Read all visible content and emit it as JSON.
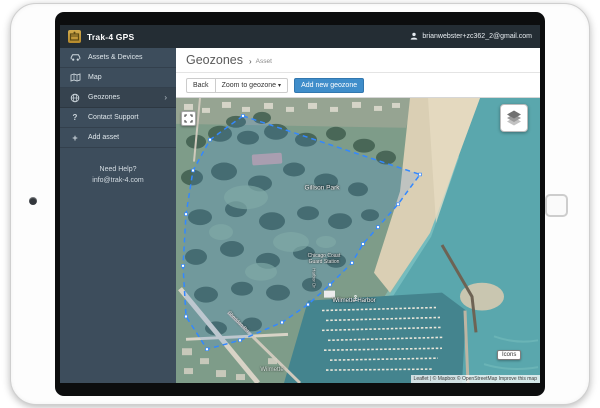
{
  "navbar": {
    "brand": "Trak-4 GPS",
    "user_email": "brianwebster+zc362_2@gmail.com"
  },
  "sidebar": {
    "items": [
      {
        "label": "Assets & Devices"
      },
      {
        "label": "Map"
      },
      {
        "label": "Geozones",
        "chevron": "›"
      },
      {
        "label": "Contact Support"
      },
      {
        "label": "Add asset"
      }
    ],
    "help_line1": "Need Help?",
    "help_line2": "info@trak-4.com"
  },
  "page": {
    "title": "Geozones",
    "breadcrumb_sep": "›",
    "breadcrumb": "Asset"
  },
  "toolbar": {
    "back": "Back",
    "zoom_to_geozone": "Zoom to geozone",
    "caret": "▾",
    "add_new_geozone": "Add new geozone"
  },
  "map": {
    "labels": {
      "park": "Gillson Park",
      "coast_guard_1": "Chicago Coast",
      "coast_guard_2": "Guard Station",
      "harbor": "Wilmette Harbor",
      "harbor_road": "Harbor Dr",
      "street": "Sheridan Rd",
      "city": "Wilmette"
    },
    "controls": {
      "icons": "Icons"
    },
    "attribution": "Leaflet | © Mapbox © OpenStreetMap Improve this map",
    "geozone": {
      "points": "67,18 244,77 222,107 202,130 187,147 176,166 154,188 132,208 106,226 64,244 31,253 10,220 7,169 10,117 17,73 34,42",
      "stroke": "#3388ff",
      "fill": "rgba(51,136,255,0.16)"
    }
  },
  "colors": {
    "accent_blue": "#3f8dca",
    "navbar_bg": "#242d34",
    "sidebar_bg": "#3d4d5c",
    "geozone_stroke": "#3388ff",
    "water": "#5aa7ad",
    "sand": "#dacfb4"
  }
}
